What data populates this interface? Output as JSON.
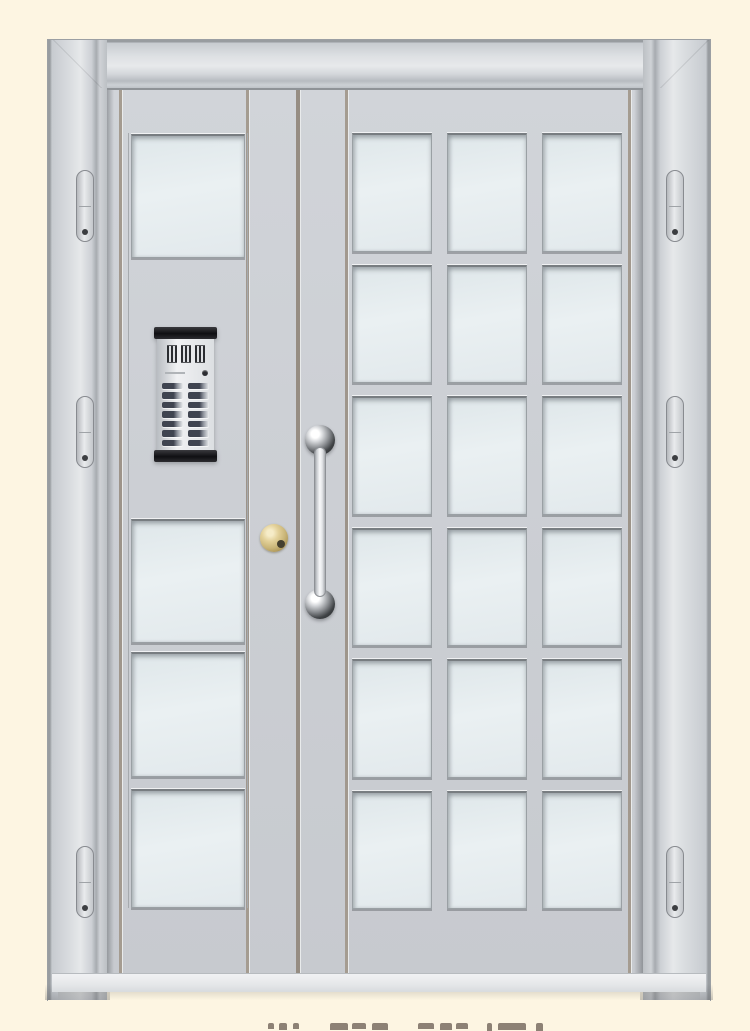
{
  "scene": {
    "kind": "product-photo",
    "subject": "Light-gray steel double entrance door (wide glazed leaf + narrow leaf) on a cream background",
    "background_color": "#fdf5e2"
  },
  "door": {
    "frame": {
      "hinges_per_side": 3
    },
    "left_leaf": {
      "glass_pane_count": 4,
      "has_intercom_panel": true
    },
    "right_leaf": {
      "glass_grid_rows": 6,
      "glass_grid_columns": 3
    },
    "hardware": {
      "pull_handle_mounts": 2,
      "lock_cylinder": true
    }
  },
  "intercom": {
    "button_rows": 7,
    "button_columns": 2,
    "elements": [
      "speaker-grille",
      "camera-lens",
      "call-buttons"
    ]
  },
  "caption": {
    "text": "",
    "cropped": true,
    "mark_groups": 12
  },
  "colors": {
    "background": "#fdf5e2",
    "frame_light": "#dfe2e5",
    "frame_mid": "#c5c9ce",
    "frame_dark": "#94989c",
    "leaf": "#cbcfd4",
    "glass": "#e4ebed",
    "groove": "#a2998e",
    "lock_gold": "#d3bf85",
    "hardware_chrome": "#3b3d40",
    "intercom_black": "#17171a"
  }
}
